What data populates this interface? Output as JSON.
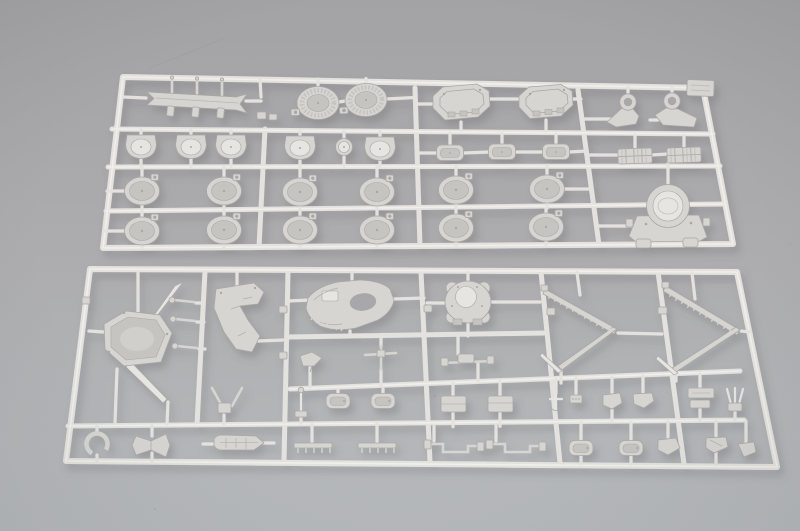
{
  "scene": {
    "type": "photograph",
    "description": "Two light-grey injection-moulded plastic model-kit sprues (part runners) from a warship model kit, photographed at a slight angle on a plain grey studio surface. The upper runner carries ribbed barbette drums, octagonal turret housings, round open gun tubs, flat roof plates, lattice platforms, crane arms and a turret base. The lower runner carries a hull platform crossed by pointed spars, a bridge bracket, a superstructure deck with oval opening, a lobed turret platform, two chevron-shaped funnel caps with ladder rungs, ship's boats, davits, masts, antennas and many small fittings.",
    "objects": [
      "upper-sprue-runner",
      "lower-sprue-runner"
    ],
    "colors": {
      "background_top": "#a3a3a5",
      "background_middle": "#adadaf",
      "background_bottom": "#b7babd",
      "plastic_rail": "#e3e2de",
      "plastic_highlight": "#f2f1ed",
      "plastic_part": "#d6d5d2",
      "plastic_part_bright": "#e6e5e1",
      "plastic_recess": "#c5c4c1",
      "plastic_edge": "#a9a8a5",
      "hole": "#a8a8aa",
      "shadow": "#5e6066"
    },
    "upper_sprue": {
      "part_groups": [
        "pin-bar",
        "barbette-drums",
        "turret-housings",
        "crane-arms",
        "roof-plates",
        "gun-tubs",
        "pan-fittings",
        "lattice-platforms",
        "turret-base"
      ]
    },
    "lower_sprue": {
      "part_groups": [
        "hull-platform-with-spars",
        "davits",
        "bridge-bracket",
        "superstructure-deck",
        "turret-platform",
        "funnel-cap-chevrons",
        "masts-and-antennas",
        "ships-boats",
        "ladder-racks",
        "linkages",
        "small-fittings"
      ]
    }
  }
}
